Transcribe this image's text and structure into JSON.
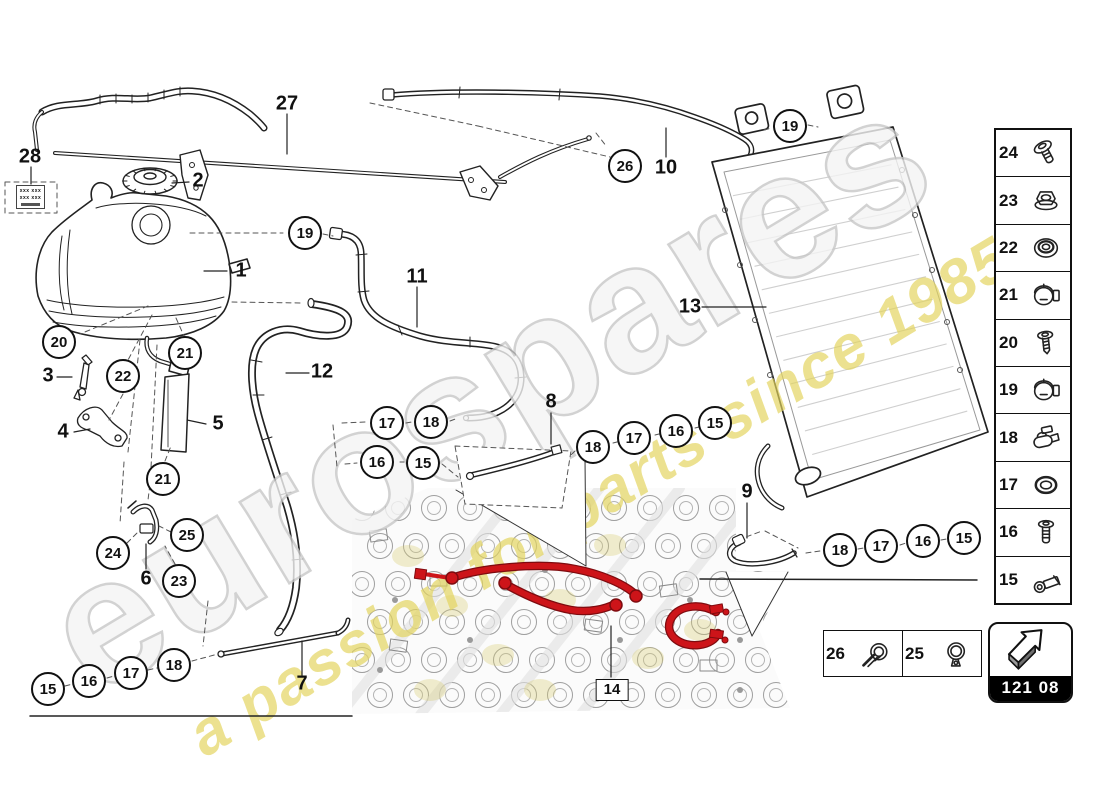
{
  "watermark": {
    "brand_text": "eurospares",
    "tagline_text": "a passion for parts since 1985",
    "brand_fill": "#f4f4f4",
    "brand_outline": "#c7c7c7",
    "tagline_color": "#e3d45c"
  },
  "diagram": {
    "highlight_color": "#cd1419",
    "highlight_dark": "#7e0b0f",
    "circled_callouts": [
      {
        "label": "19",
        "x": 305,
        "y": 233
      },
      {
        "label": "19",
        "x": 790,
        "y": 126
      },
      {
        "label": "26",
        "x": 625,
        "y": 166
      },
      {
        "label": "20",
        "x": 59,
        "y": 342
      },
      {
        "label": "22",
        "x": 123,
        "y": 376
      },
      {
        "label": "21",
        "x": 185,
        "y": 353
      },
      {
        "label": "21",
        "x": 163,
        "y": 479
      },
      {
        "label": "24",
        "x": 113,
        "y": 553
      },
      {
        "label": "25",
        "x": 187,
        "y": 535
      },
      {
        "label": "23",
        "x": 179,
        "y": 581
      },
      {
        "label": "15",
        "x": 48,
        "y": 689
      },
      {
        "label": "16",
        "x": 89,
        "y": 681
      },
      {
        "label": "17",
        "x": 131,
        "y": 673
      },
      {
        "label": "18",
        "x": 174,
        "y": 665
      },
      {
        "label": "17",
        "x": 387,
        "y": 423
      },
      {
        "label": "18",
        "x": 431,
        "y": 422
      },
      {
        "label": "16",
        "x": 377,
        "y": 462
      },
      {
        "label": "15",
        "x": 423,
        "y": 463
      },
      {
        "label": "18",
        "x": 593,
        "y": 447
      },
      {
        "label": "17",
        "x": 634,
        "y": 438
      },
      {
        "label": "16",
        "x": 676,
        "y": 431
      },
      {
        "label": "15",
        "x": 715,
        "y": 423
      },
      {
        "label": "18",
        "x": 840,
        "y": 550
      },
      {
        "label": "17",
        "x": 881,
        "y": 546
      },
      {
        "label": "16",
        "x": 923,
        "y": 541
      },
      {
        "label": "15",
        "x": 964,
        "y": 538
      }
    ],
    "plain_labels": [
      {
        "label": "27",
        "x": 287,
        "y": 104
      },
      {
        "label": "28",
        "x": 30,
        "y": 157
      },
      {
        "label": "2",
        "x": 198,
        "y": 181
      },
      {
        "label": "1",
        "x": 241,
        "y": 271
      },
      {
        "label": "11",
        "x": 417,
        "y": 277
      },
      {
        "label": "12",
        "x": 322,
        "y": 372
      },
      {
        "label": "3",
        "x": 48,
        "y": 376
      },
      {
        "label": "4",
        "x": 63,
        "y": 432
      },
      {
        "label": "5",
        "x": 218,
        "y": 424
      },
      {
        "label": "6",
        "x": 146,
        "y": 579
      },
      {
        "label": "10",
        "x": 666,
        "y": 168
      },
      {
        "label": "13",
        "x": 690,
        "y": 307
      },
      {
        "label": "8",
        "x": 551,
        "y": 402
      },
      {
        "label": "9",
        "x": 747,
        "y": 492
      },
      {
        "label": "7",
        "x": 302,
        "y": 684
      }
    ],
    "boxed_label": {
      "label": "14",
      "x": 612,
      "y": 690
    },
    "sticker": {
      "line1": "xxx xxx",
      "line2": "xxx xxx"
    }
  },
  "sidebar": {
    "items": [
      {
        "number": "24",
        "icon": "pan-head-screw"
      },
      {
        "number": "23",
        "icon": "flange-nut"
      },
      {
        "number": "22",
        "icon": "grommet-seal"
      },
      {
        "number": "21",
        "icon": "hose-clamp"
      },
      {
        "number": "20",
        "icon": "tapping-screw"
      },
      {
        "number": "19",
        "icon": "hose-clamp"
      },
      {
        "number": "18",
        "icon": "spring-clip"
      },
      {
        "number": "17",
        "icon": "o-ring"
      },
      {
        "number": "16",
        "icon": "bolt"
      },
      {
        "number": "15",
        "icon": "banjo-fitting"
      }
    ]
  },
  "legend": {
    "items": [
      {
        "number": "26",
        "icon": "clamp-with-tool"
      },
      {
        "number": "25",
        "icon": "ear-clamp"
      }
    ]
  },
  "badge": {
    "code": "121 08",
    "icon": "direction-arrow"
  }
}
